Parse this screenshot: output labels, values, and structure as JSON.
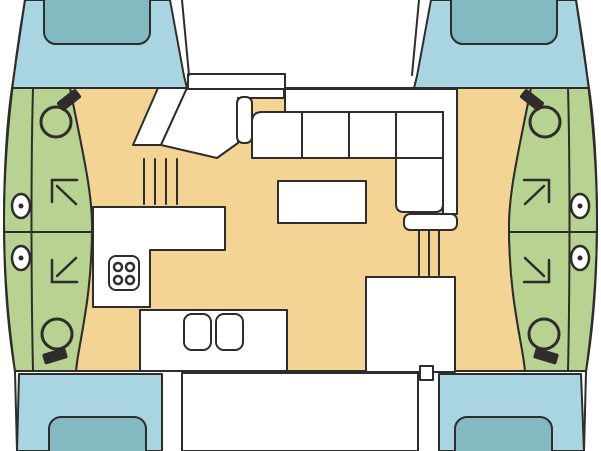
{
  "diagram": {
    "type": "catamaran-interior-floor-plan",
    "orientation": "bow-up",
    "rooms": [
      "foredeck-port",
      "foredeck-starboard",
      "trampoline",
      "port-hull-cabins",
      "starboard-hull-cabins",
      "salon",
      "galley",
      "cockpit",
      "stern-deck-port",
      "stern-deck-starboard"
    ]
  },
  "palette": {
    "deck_blue": "#a9d4e1",
    "hatch_teal": "#83b9c0",
    "hull_green": "#b7d291",
    "floor_tan": "#f4d494",
    "outline": "#2e2d2b",
    "white": "#ffffff"
  },
  "fixtures": {
    "toilets": [
      {
        "cx": 56,
        "cy": 122,
        "r": 15,
        "seat": {
          "cx": 69,
          "cy": 100,
          "rot": -38
        }
      },
      {
        "cx": 545,
        "cy": 122,
        "r": 15,
        "seat": {
          "cx": 532,
          "cy": 100,
          "rot": 38
        }
      },
      {
        "cx": 57,
        "cy": 334,
        "r": 15,
        "seat": {
          "cx": 55,
          "cy": 356,
          "rot": -17
        }
      },
      {
        "cx": 544,
        "cy": 334,
        "r": 15,
        "seat": {
          "cx": 546,
          "cy": 356,
          "rot": 17
        }
      }
    ],
    "portholes": [
      {
        "cx": 21,
        "cy": 206
      },
      {
        "cx": 21,
        "cy": 258
      },
      {
        "cx": 580,
        "cy": 206
      },
      {
        "cx": 580,
        "cy": 258
      }
    ],
    "porthole_rx": 9,
    "porthole_ry": 12,
    "porthole_dot_r": 2.5,
    "berth_arrows": [
      {
        "dir": "up-left",
        "lines": [
          [
            52,
            180,
            77,
            180
          ],
          [
            52,
            180,
            52,
            202
          ],
          [
            57,
            186,
            76,
            204
          ]
        ]
      },
      {
        "dir": "up-right",
        "lines": [
          [
            524,
            180,
            549,
            180
          ],
          [
            549,
            180,
            549,
            202
          ],
          [
            544,
            186,
            525,
            204
          ]
        ]
      },
      {
        "dir": "down-left",
        "lines": [
          [
            52,
            282,
            77,
            282
          ],
          [
            52,
            260,
            52,
            282
          ],
          [
            57,
            276,
            76,
            258
          ]
        ]
      },
      {
        "dir": "down-right",
        "lines": [
          [
            524,
            282,
            549,
            282
          ],
          [
            549,
            260,
            549,
            282
          ],
          [
            544,
            276,
            525,
            258
          ]
        ]
      }
    ],
    "stove": {
      "x": 109,
      "y": 256,
      "w": 30,
      "h": 34,
      "rx": 7,
      "burner_r": 4,
      "burners": [
        [
          118,
          267
        ],
        [
          130,
          267
        ],
        [
          118,
          280
        ],
        [
          130,
          280
        ]
      ]
    },
    "sinks": [
      {
        "x": 184,
        "y": 314,
        "w": 27,
        "h": 36,
        "rx": 8
      },
      {
        "x": 216,
        "y": 314,
        "w": 27,
        "h": 36,
        "rx": 8
      }
    ],
    "deck_hatches": [
      {
        "x": 44,
        "y": -14,
        "w": 106,
        "h": 58,
        "rx": 12
      },
      {
        "x": 451,
        "y": -14,
        "w": 106,
        "h": 58,
        "rx": 12
      },
      {
        "x": 49,
        "y": 417,
        "w": 97,
        "h": 50,
        "rx": 12
      },
      {
        "x": 455,
        "y": 417,
        "w": 97,
        "h": 50,
        "rx": 12
      }
    ],
    "stairs": [
      {
        "name": "stairs-port",
        "lines": [
          [
            144,
            159,
            144,
            204
          ],
          [
            155,
            159,
            155,
            204
          ],
          [
            166,
            159,
            166,
            204
          ],
          [
            177,
            159,
            177,
            204
          ]
        ]
      },
      {
        "name": "stairs-starboard",
        "lines": [
          [
            419,
            231,
            419,
            275
          ],
          [
            429,
            231,
            429,
            275
          ],
          [
            439,
            231,
            439,
            275
          ]
        ]
      }
    ]
  }
}
